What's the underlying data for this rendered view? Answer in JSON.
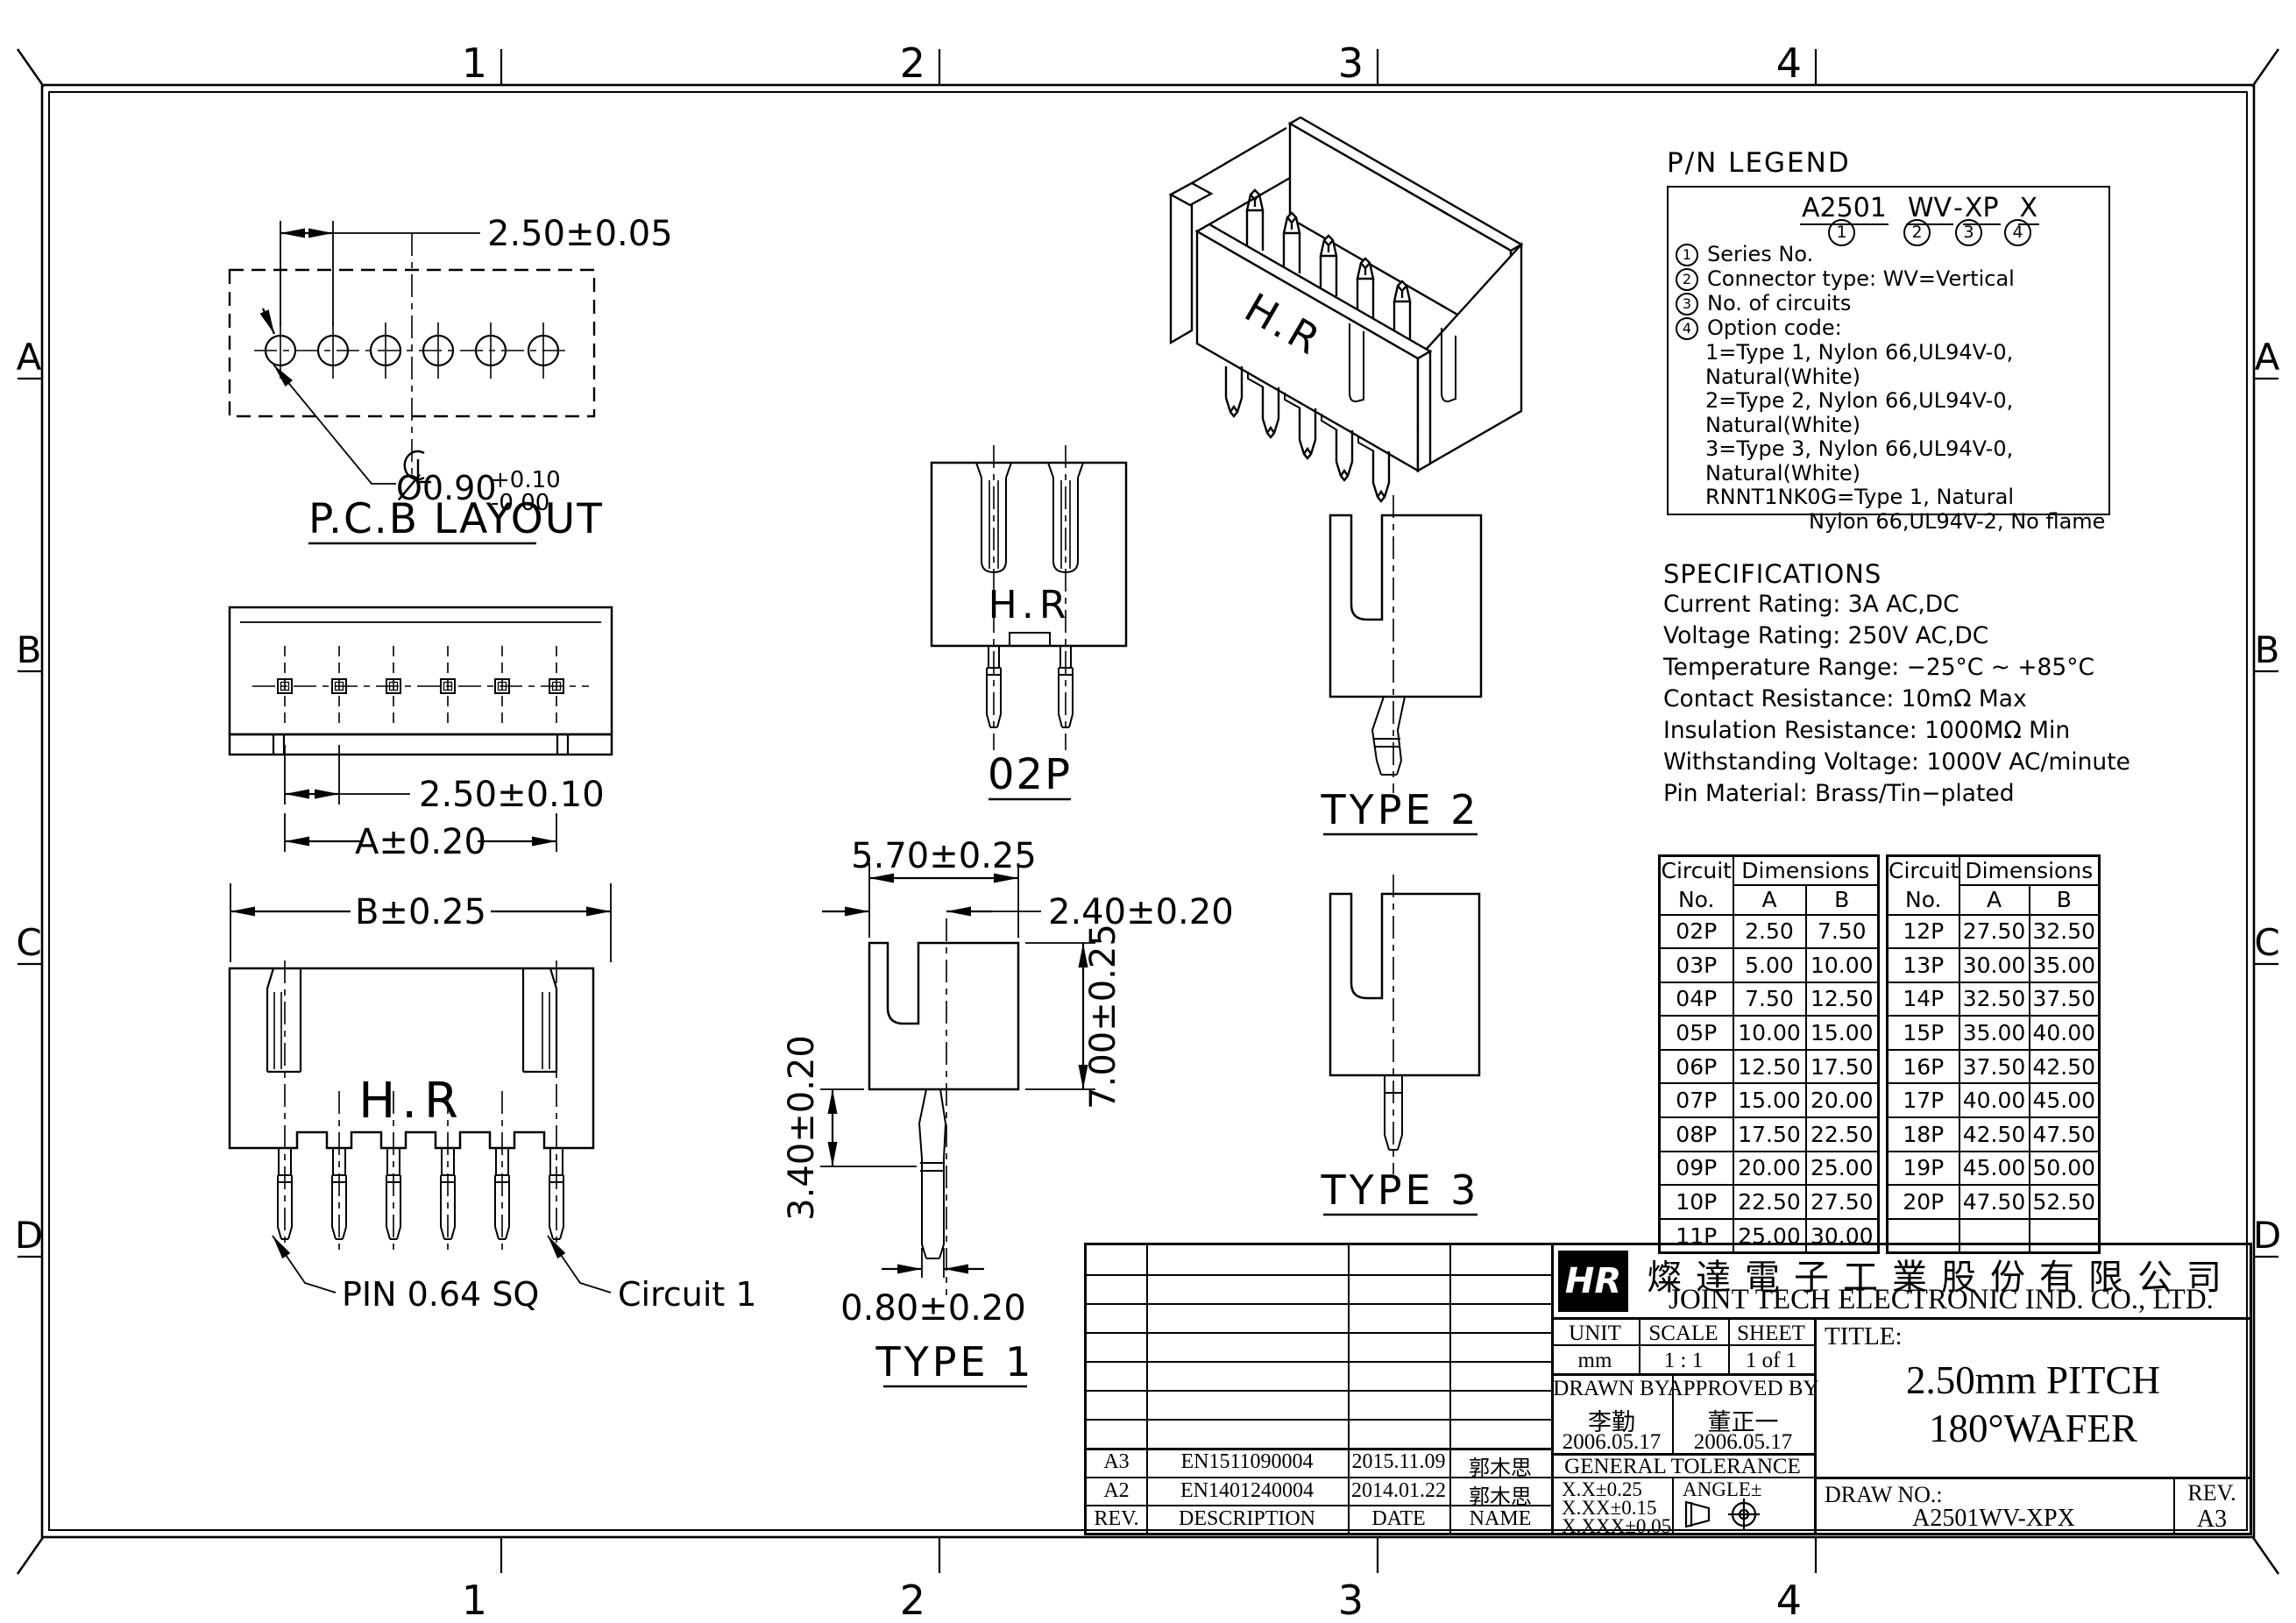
{
  "frame": {
    "zone_cols": [
      "1",
      "2",
      "3",
      "4"
    ],
    "zone_rows": [
      "A",
      "B",
      "C",
      "D"
    ]
  },
  "views": {
    "pcb_layout": {
      "label": "P.C.B LAYOUT",
      "dim_pitch": "2.50±0.05",
      "dim_hole_dia": "Ø0.90",
      "dim_hole_tol_plus": "+0.10",
      "dim_hole_tol_minus": "-0.00"
    },
    "top_view": {
      "dim_pitch": "2.50±0.10",
      "dim_a": "A±0.20",
      "dim_b": "B±0.25"
    },
    "front_view": {
      "brand": "H.R",
      "pin_label": "PIN 0.64 SQ",
      "circuit_label": "Circuit 1"
    },
    "side_view": {
      "dim_width": "5.70±0.25",
      "dim_offset": "2.40±0.20",
      "dim_height": "7.00±0.25",
      "dim_pin_upper": "3.40±0.20",
      "dim_pin_width": "0.80±0.20",
      "label": "TYPE 1"
    },
    "view_02p": {
      "brand": "H.R",
      "label": "02P"
    },
    "type2": {
      "label": "TYPE 2"
    },
    "type3": {
      "label": "TYPE 3"
    },
    "isometric": {
      "brand": "H.R"
    }
  },
  "pn_legend": {
    "title": "P/N LEGEND",
    "part": {
      "seg1": "A2501",
      "seg2": "WV",
      "dash": "-",
      "seg3": "XP",
      "seg4": "X"
    },
    "markers": [
      "1",
      "2",
      "3",
      "4"
    ],
    "items": [
      {
        "num": "1",
        "text": "Series No."
      },
      {
        "num": "2",
        "text": "Connector type: WV=Vertical"
      },
      {
        "num": "3",
        "text": "No. of circuits"
      },
      {
        "num": "4",
        "text": "Option code:"
      }
    ],
    "options": [
      "1=Type 1, Nylon 66,UL94V-0, Natural(White)",
      "2=Type 2, Nylon 66,UL94V-0, Natural(White)",
      "3=Type 3, Nylon 66,UL94V-0, Natural(White)",
      "RNNT1NK0G=Type 1, Natural"
    ],
    "option_cont": "Nylon 66,UL94V-2, No flame"
  },
  "specifications": {
    "title": "SPECIFICATIONS",
    "lines": [
      "Current Rating: 3A AC,DC",
      "Voltage Rating: 250V AC,DC",
      "Temperature Range: −25°C ~ +85°C",
      "Contact Resistance: 10mΩ Max",
      "Insulation Resistance: 1000MΩ Min",
      "Withstanding Voltage: 1000V AC/minute",
      "Pin Material: Brass/Tin−plated"
    ]
  },
  "circuit_table": {
    "header": {
      "circuit": "Circuit",
      "no": "No.",
      "dimensions": "Dimensions",
      "col_a": "A",
      "col_b": "B"
    },
    "left_rows": [
      {
        "no": "02P",
        "a": "2.50",
        "b": "7.50"
      },
      {
        "no": "03P",
        "a": "5.00",
        "b": "10.00"
      },
      {
        "no": "04P",
        "a": "7.50",
        "b": "12.50"
      },
      {
        "no": "05P",
        "a": "10.00",
        "b": "15.00"
      },
      {
        "no": "06P",
        "a": "12.50",
        "b": "17.50"
      },
      {
        "no": "07P",
        "a": "15.00",
        "b": "20.00"
      },
      {
        "no": "08P",
        "a": "17.50",
        "b": "22.50"
      },
      {
        "no": "09P",
        "a": "20.00",
        "b": "25.00"
      },
      {
        "no": "10P",
        "a": "22.50",
        "b": "27.50"
      },
      {
        "no": "11P",
        "a": "25.00",
        "b": "30.00"
      }
    ],
    "right_rows": [
      {
        "no": "12P",
        "a": "27.50",
        "b": "32.50"
      },
      {
        "no": "13P",
        "a": "30.00",
        "b": "35.00"
      },
      {
        "no": "14P",
        "a": "32.50",
        "b": "37.50"
      },
      {
        "no": "15P",
        "a": "35.00",
        "b": "40.00"
      },
      {
        "no": "16P",
        "a": "37.50",
        "b": "42.50"
      },
      {
        "no": "17P",
        "a": "40.00",
        "b": "45.00"
      },
      {
        "no": "18P",
        "a": "42.50",
        "b": "47.50"
      },
      {
        "no": "19P",
        "a": "45.00",
        "b": "50.00"
      },
      {
        "no": "20P",
        "a": "47.50",
        "b": "52.50"
      },
      {
        "no": "",
        "a": "",
        "b": ""
      }
    ]
  },
  "title_block": {
    "company_cn": "燦達電子工業股份有限公司",
    "company_en": "JOINT TECH ELECTRONIC IND. CO., LTD.",
    "logo_text": "HR",
    "unit_label": "UNIT",
    "unit_value": "mm",
    "scale_label": "SCALE",
    "scale_value": "1 : 1",
    "sheet_label": "SHEET",
    "sheet_value": "1 of 1",
    "drawn_label": "DRAWN BY",
    "drawn_name": "李勤",
    "drawn_date": "2006.05.17",
    "approved_label": "APPROVED BY",
    "approved_name": "董正一",
    "approved_date": "2006.05.17",
    "general_tolerance": "GENERAL TOLERANCE",
    "tolerances": [
      "X.X±0.25",
      "X.XX±0.15",
      "X.XXX±0.05"
    ],
    "angle_label": "ANGLE±",
    "title_label": "TITLE:",
    "title_line1": "2.50mm PITCH",
    "title_line2": "180°WAFER",
    "draw_no_label": "DRAW NO.:",
    "draw_no": "A2501WV-XPX",
    "rev_label": "REV.",
    "rev_value": "A3",
    "rev_headers": {
      "rev": "REV.",
      "desc": "DESCRIPTION",
      "date": "DATE",
      "name": "NAME"
    },
    "revisions": [
      {
        "rev": "A3",
        "desc": "EN1511090004",
        "date": "2015.11.09",
        "name": "郭木思"
      },
      {
        "rev": "A2",
        "desc": "EN1401240004",
        "date": "2014.01.22",
        "name": "郭木思"
      }
    ]
  }
}
